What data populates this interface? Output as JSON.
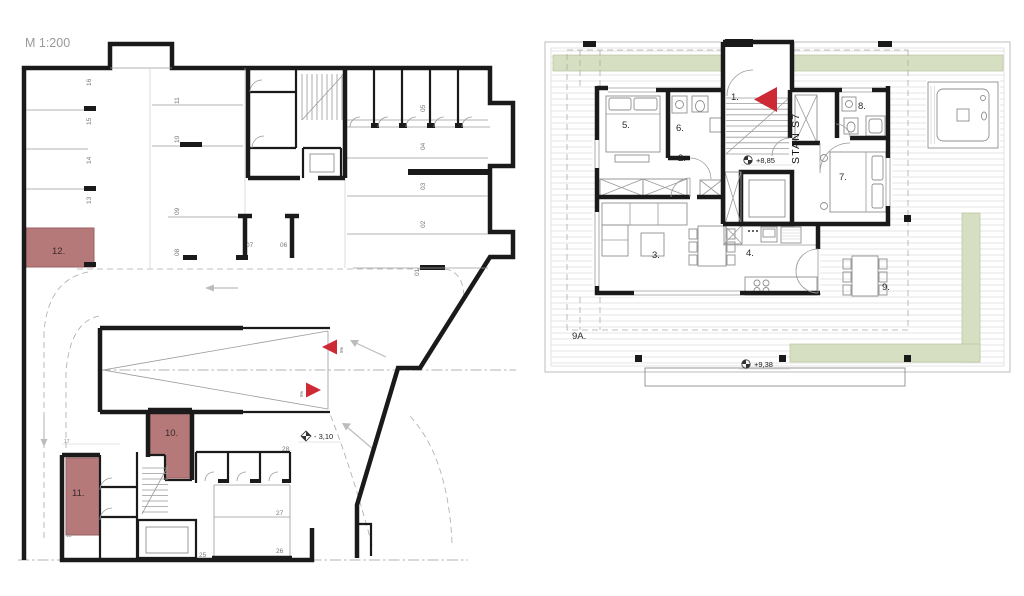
{
  "colors": {
    "wall": "#1a1a1a",
    "highlight": "#b5797a",
    "highlight_border": "#9a5f61",
    "accent_red": "#cd2a36",
    "terrace_green": "#d7dfc3"
  },
  "garage": {
    "scale_label": "M 1:200",
    "parking_left": [
      "16",
      "15",
      "14",
      "13"
    ],
    "parking_mid_upper": [
      "11",
      "10"
    ],
    "parking_mid_lower": [
      "09",
      "08"
    ],
    "parking_mid_horiz": [
      "07",
      "06"
    ],
    "parking_right": [
      "05",
      "04",
      "03",
      "02",
      "01"
    ],
    "parking_bottom": [
      "28.",
      "27",
      "26"
    ],
    "stair_cell": "25",
    "storage_small": [
      "17",
      "18"
    ],
    "unit12": "12.",
    "unit10": "10.",
    "unit11": "11.",
    "elevation": "- 3,10",
    "slope_a": "5%",
    "slope_b": "5%"
  },
  "apartment": {
    "unit_label": "STAN S7",
    "rooms": {
      "r1": "1.",
      "r2": "2.",
      "r3": "3.",
      "r4": "4.",
      "r5": "5.",
      "r6": "6.",
      "r7": "7.",
      "r8": "8.",
      "r9": "9.",
      "r9a": "9A."
    },
    "elevation_inner": "+8,85",
    "elevation_terrace": "+9,38"
  }
}
